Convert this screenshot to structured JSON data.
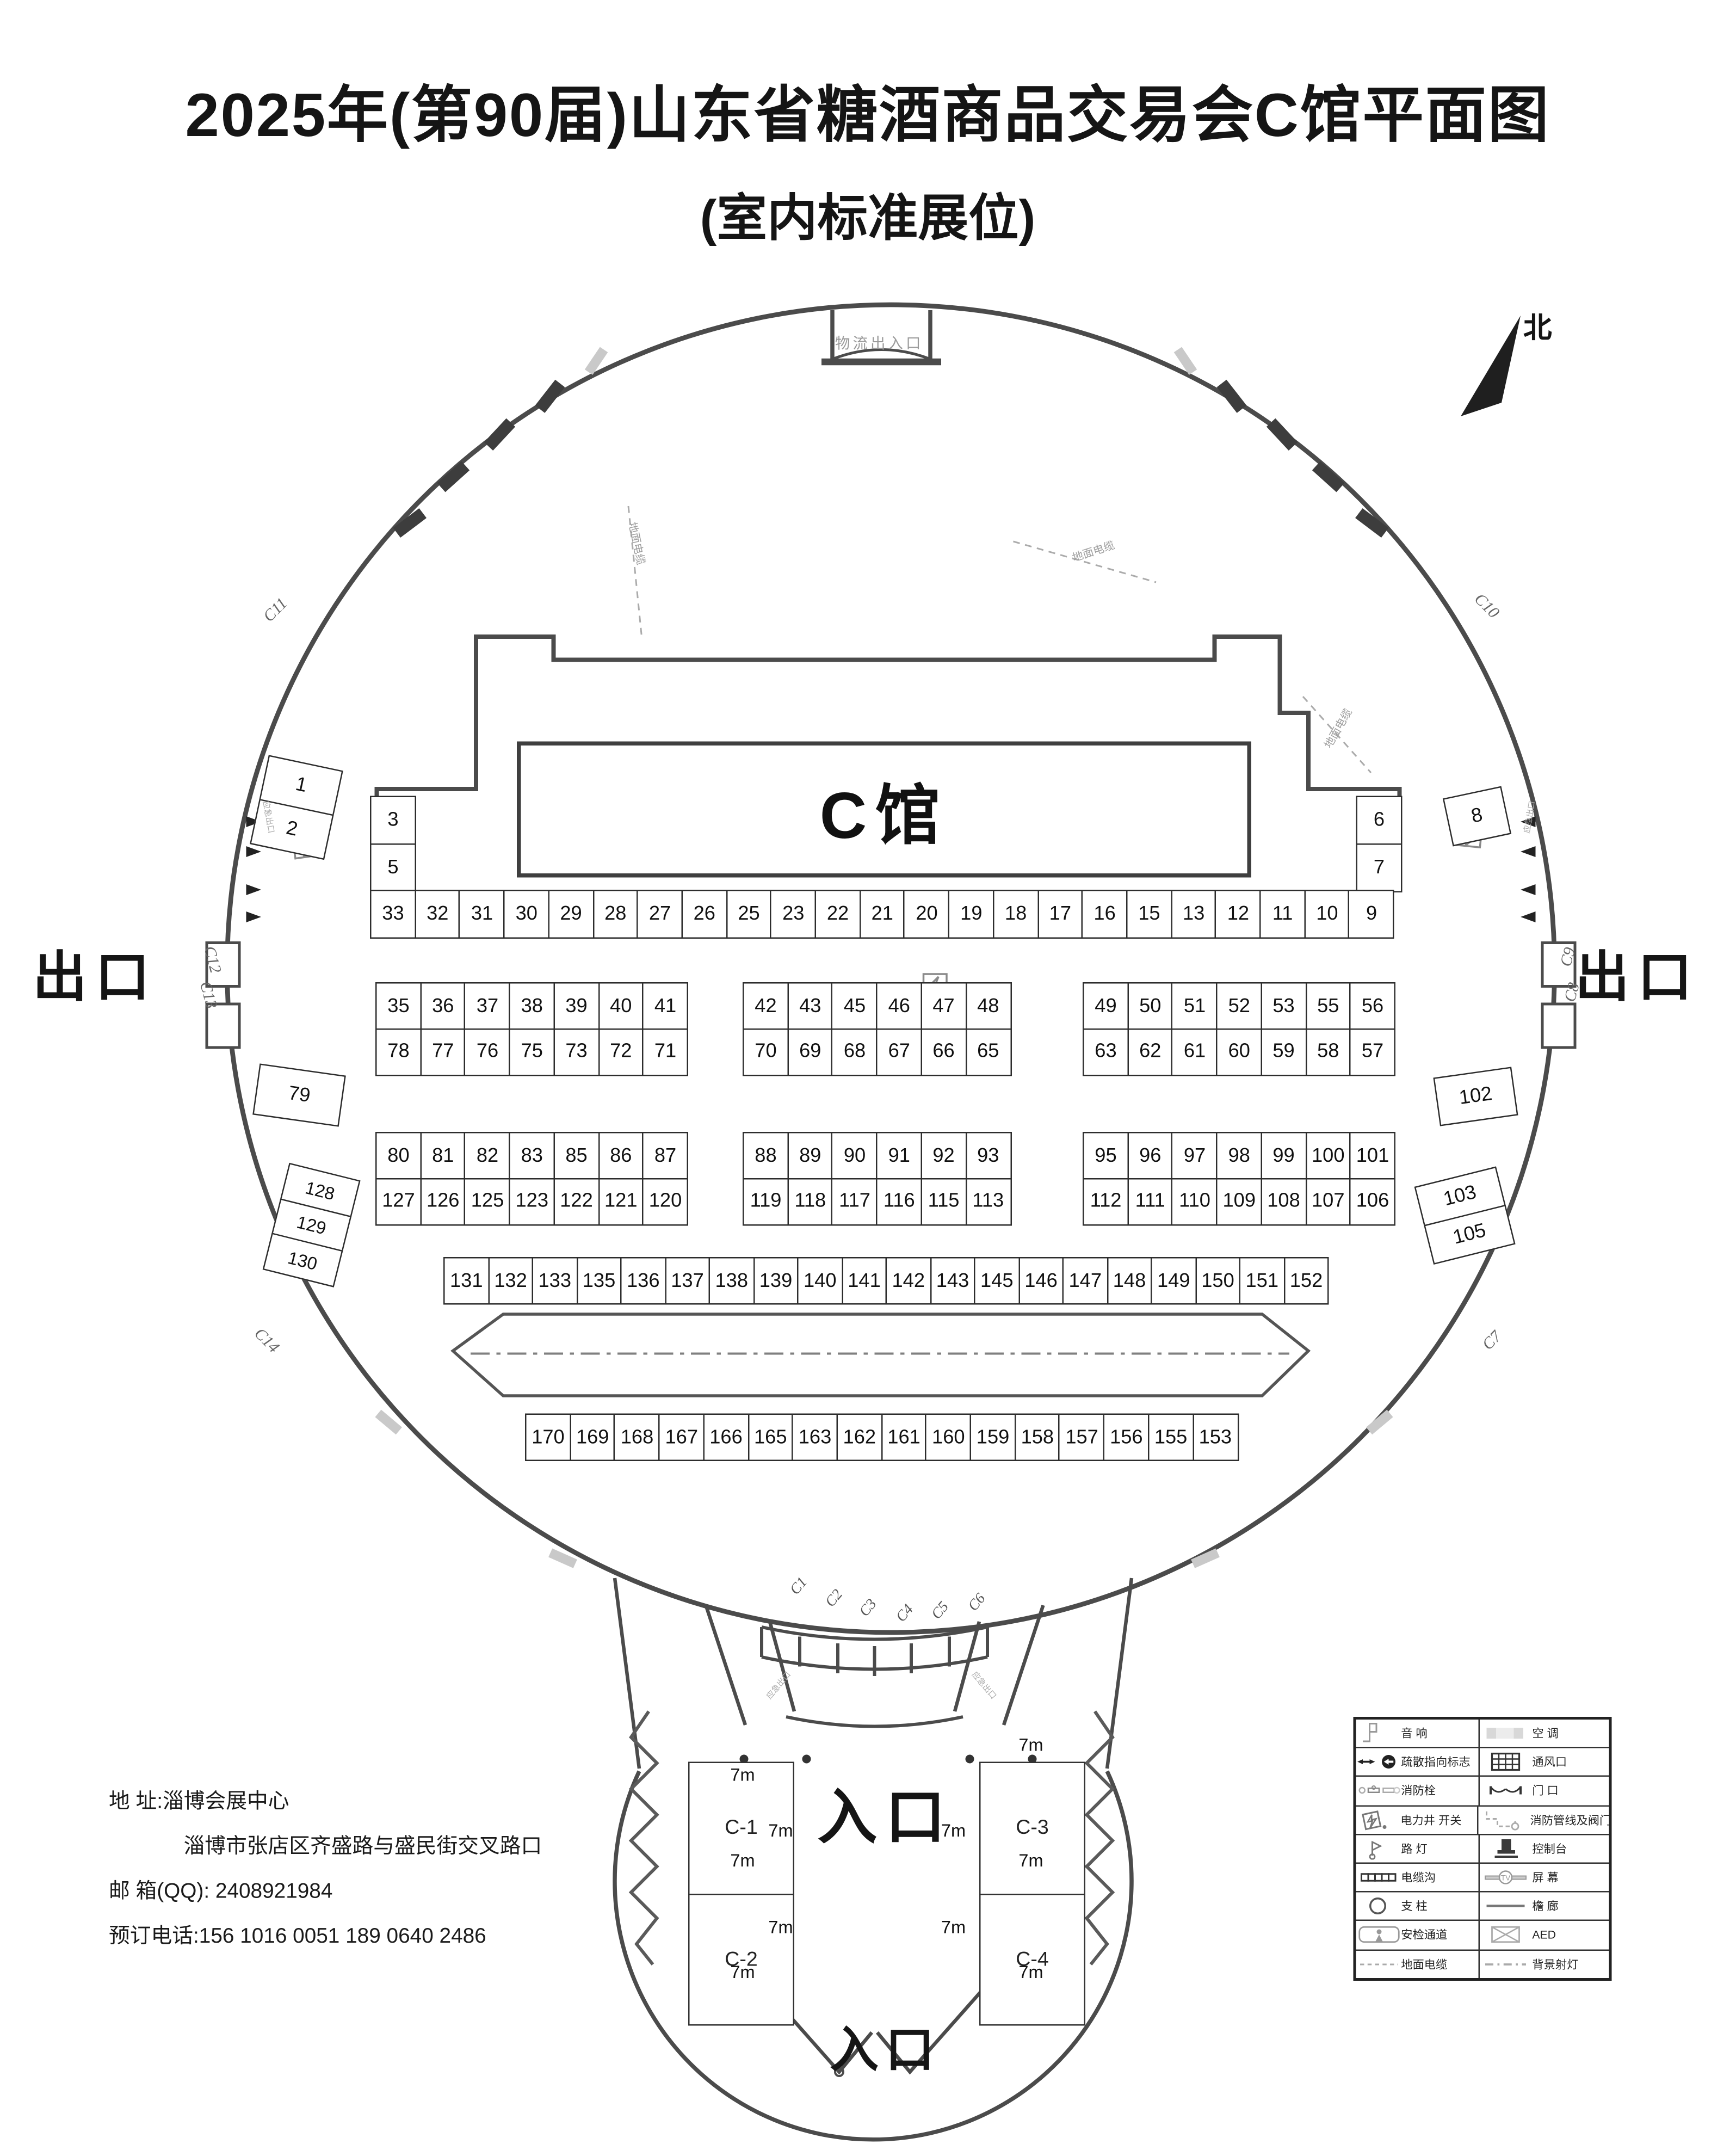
{
  "title": {
    "line1": "2025年(第90届)山东省糖酒商品交易会C馆平面图",
    "line2": "(室内标准展位)"
  },
  "north_label": "北",
  "hall_label": "C馆",
  "logistics_gate_label": "物流出入口",
  "exit_left": "出口",
  "exit_right": "出口",
  "entrance_main": "入口",
  "entrance_bottom": "入口",
  "emergency_exit_label": "应急出口",
  "ground_cable_label": "地面电缆",
  "booths": {
    "left_stack": [
      "3",
      "5"
    ],
    "right_stack": [
      "6",
      "7"
    ],
    "top_row": [
      "33",
      "32",
      "31",
      "30",
      "29",
      "28",
      "27",
      "26",
      "25",
      "23",
      "22",
      "21",
      "20",
      "19",
      "18",
      "17",
      "16",
      "15",
      "13",
      "12",
      "11",
      "10",
      "9"
    ],
    "block_a": {
      "left_r1": [
        "35",
        "36",
        "37",
        "38",
        "39",
        "40",
        "41"
      ],
      "left_r2": [
        "78",
        "77",
        "76",
        "75",
        "73",
        "72",
        "71"
      ],
      "mid_r1": [
        "42",
        "43",
        "45",
        "46",
        "47",
        "48"
      ],
      "mid_r2": [
        "70",
        "69",
        "68",
        "67",
        "66",
        "65"
      ],
      "right_r1": [
        "49",
        "50",
        "51",
        "52",
        "53",
        "55",
        "56"
      ],
      "right_r2": [
        "63",
        "62",
        "61",
        "60",
        "59",
        "58",
        "57"
      ]
    },
    "block_b": {
      "left_r1": [
        "80",
        "81",
        "82",
        "83",
        "85",
        "86",
        "87"
      ],
      "left_r2": [
        "127",
        "126",
        "125",
        "123",
        "122",
        "121",
        "120"
      ],
      "mid_r1": [
        "88",
        "89",
        "90",
        "91",
        "92",
        "93"
      ],
      "mid_r2": [
        "119",
        "118",
        "117",
        "116",
        "115",
        "113"
      ],
      "right_r1": [
        "95",
        "96",
        "97",
        "98",
        "99",
        "100",
        "101"
      ],
      "right_r2": [
        "112",
        "111",
        "110",
        "109",
        "108",
        "107",
        "106"
      ]
    },
    "row_c": [
      "131",
      "132",
      "133",
      "135",
      "136",
      "137",
      "138",
      "139",
      "140",
      "141",
      "142",
      "143",
      "145",
      "146",
      "147",
      "148",
      "149",
      "150",
      "151",
      "152"
    ],
    "row_d": [
      "170",
      "169",
      "168",
      "167",
      "166",
      "165",
      "163",
      "162",
      "161",
      "160",
      "159",
      "158",
      "157",
      "156",
      "155",
      "153"
    ],
    "left_pair": [
      "1",
      "2"
    ],
    "left_single": [
      "79"
    ],
    "left_triple": [
      "128",
      "129",
      "130"
    ],
    "right_single": [
      "8"
    ],
    "right_mid": [
      "102"
    ],
    "right_pair": [
      "103",
      "105"
    ]
  },
  "big_booths": {
    "c1": "C-1",
    "c2": "C-2",
    "c3": "C-3",
    "c4": "C-4",
    "dim": "7m"
  },
  "gate_labels": {
    "c11": "C11",
    "c12": "C12",
    "c13": "C13",
    "c14": "C14",
    "c10": "C10",
    "c9": "C9",
    "c8": "C8",
    "c7": "C7",
    "arc": [
      "C1",
      "C2",
      "C3",
      "C4",
      "C5",
      "C6"
    ]
  },
  "legend": {
    "rows": [
      {
        "left": "音 响",
        "right": "空 调"
      },
      {
        "left": "疏散指向标志",
        "right": "通风口"
      },
      {
        "left": "消防栓",
        "right": "门 口"
      },
      {
        "left": "电力井 开关",
        "right": "消防管线及阀门"
      },
      {
        "left": "路 灯",
        "right": "控制台"
      },
      {
        "left": "电缆沟",
        "right": "屏 幕"
      },
      {
        "left": "支 柱",
        "right": "檐 廊"
      },
      {
        "left": "安检通道",
        "right": "AED"
      },
      {
        "left": "地面电缆",
        "right": "背景射灯"
      }
    ]
  },
  "contact": {
    "line1": "地  址:淄博会展中心",
    "line2": "淄博市张店区齐盛路与盛民街交叉路口",
    "line3": "邮 箱(QQ): 2408921984",
    "line4": "预订电话:156 1016 0051  189 0640 2486"
  }
}
